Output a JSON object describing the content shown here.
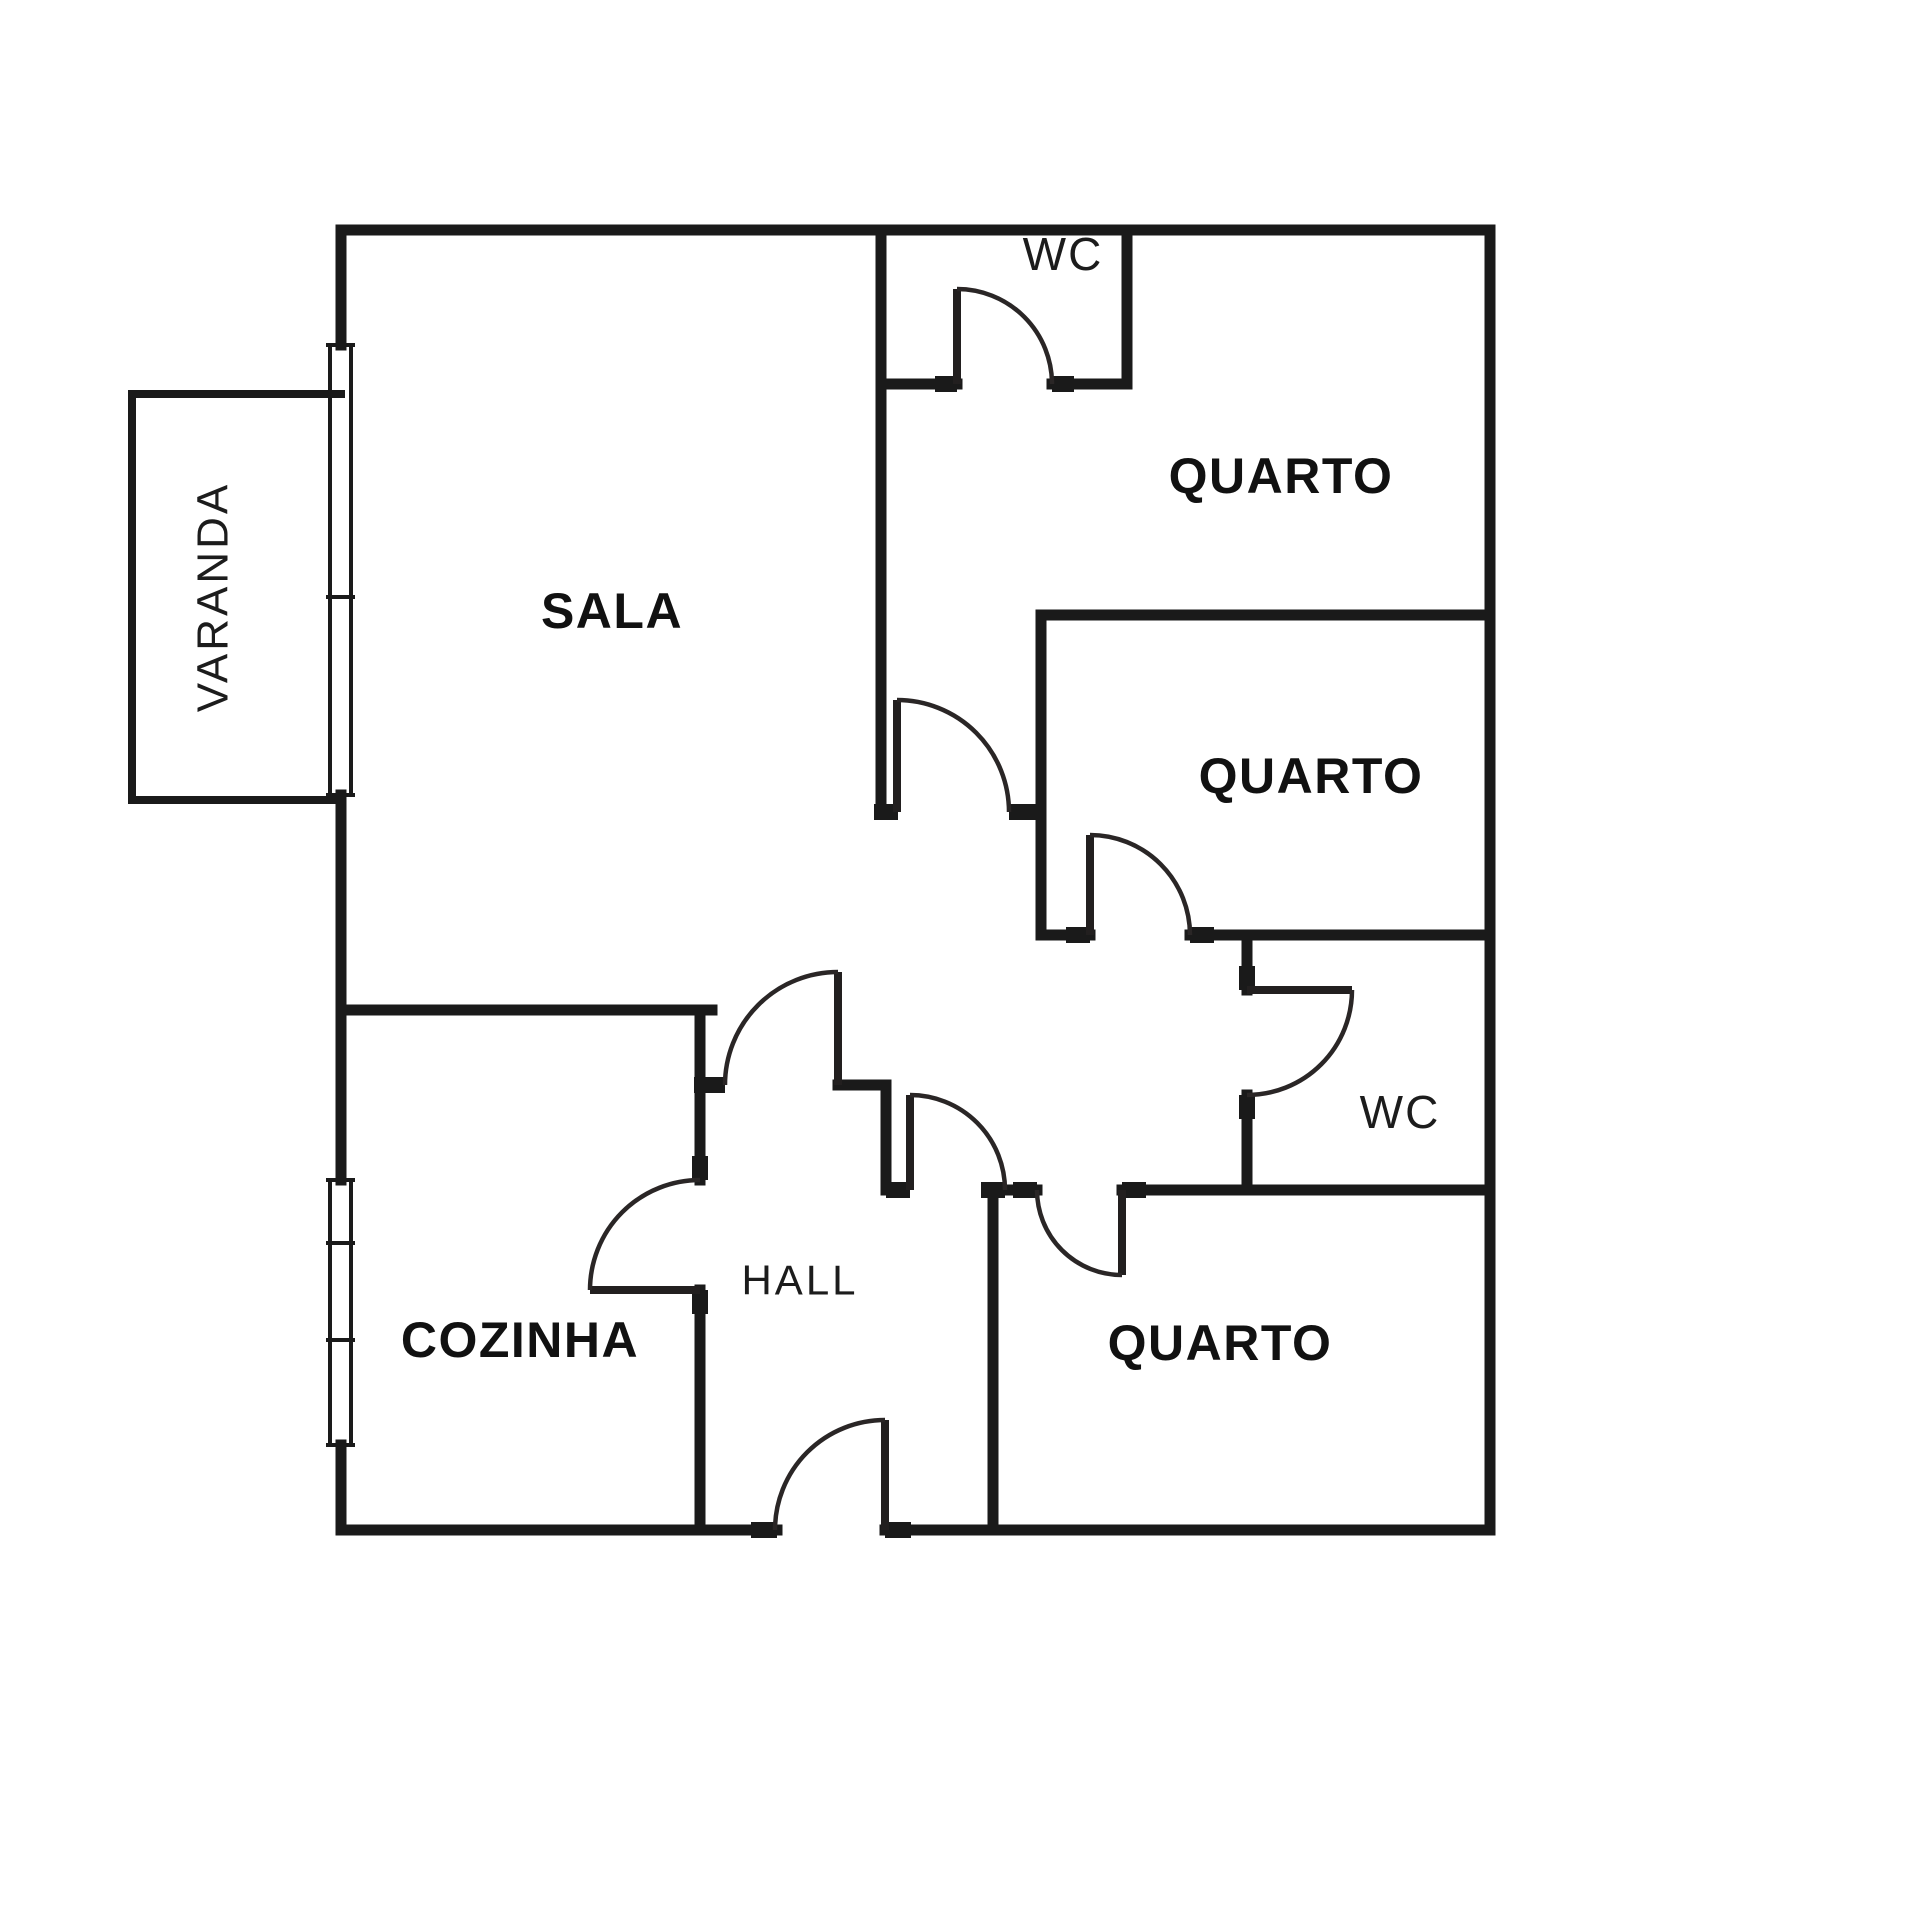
{
  "document": {
    "type": "floor-plan",
    "background_color": "#ffffff",
    "wall_color": "#1a1a1a",
    "text_color": "#111111"
  },
  "rooms": {
    "varanda": {
      "label": "VARANDA"
    },
    "sala": {
      "label": "SALA"
    },
    "wc_top": {
      "label": "WC"
    },
    "quarto_top": {
      "label": "QUARTO"
    },
    "quarto_middle": {
      "label": "QUARTO"
    },
    "wc_middle": {
      "label": "WC"
    },
    "quarto_bottom": {
      "label": "QUARTO"
    },
    "cozinha": {
      "label": "COZINHA"
    },
    "hall": {
      "label": "HALL"
    }
  }
}
